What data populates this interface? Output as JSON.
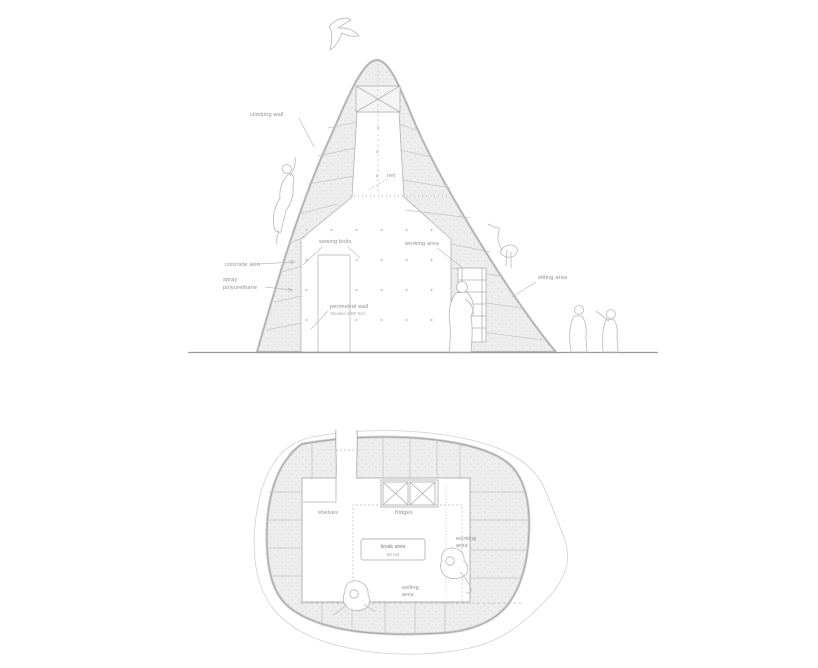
{
  "drawing": {
    "title": "architectural section and floor plan",
    "colors": {
      "background": "#ffffff",
      "linework": "#b3b6b6",
      "linework_dark": "#a2a5a5",
      "ground_line": "#9b9b9b",
      "wall_fill": "#ededed",
      "label_text": "#8f8f8f"
    }
  },
  "section": {
    "labels": {
      "climbing_wall": "climbing wall",
      "net": "net",
      "sewing_bolts": "sewing bolts",
      "working_area": "working area",
      "concrete_skin": "concrete skin",
      "spray_line1": "spray",
      "spray_line2": "polyurethane",
      "perimetral_wall": "perimetral wall",
      "perimetral_wall_detail": "Wooden MDF 5cm",
      "sitting_area": "sitting area"
    }
  },
  "plan": {
    "labels": {
      "shelves": "shelves",
      "fridges": "fridges",
      "kiosk_area": "kiosk area",
      "kiosk_area_size": "10 m2",
      "working_area_line1": "working",
      "working_area_line2": "area",
      "selling_area_line1": "selling",
      "selling_area_line2": "area"
    }
  }
}
